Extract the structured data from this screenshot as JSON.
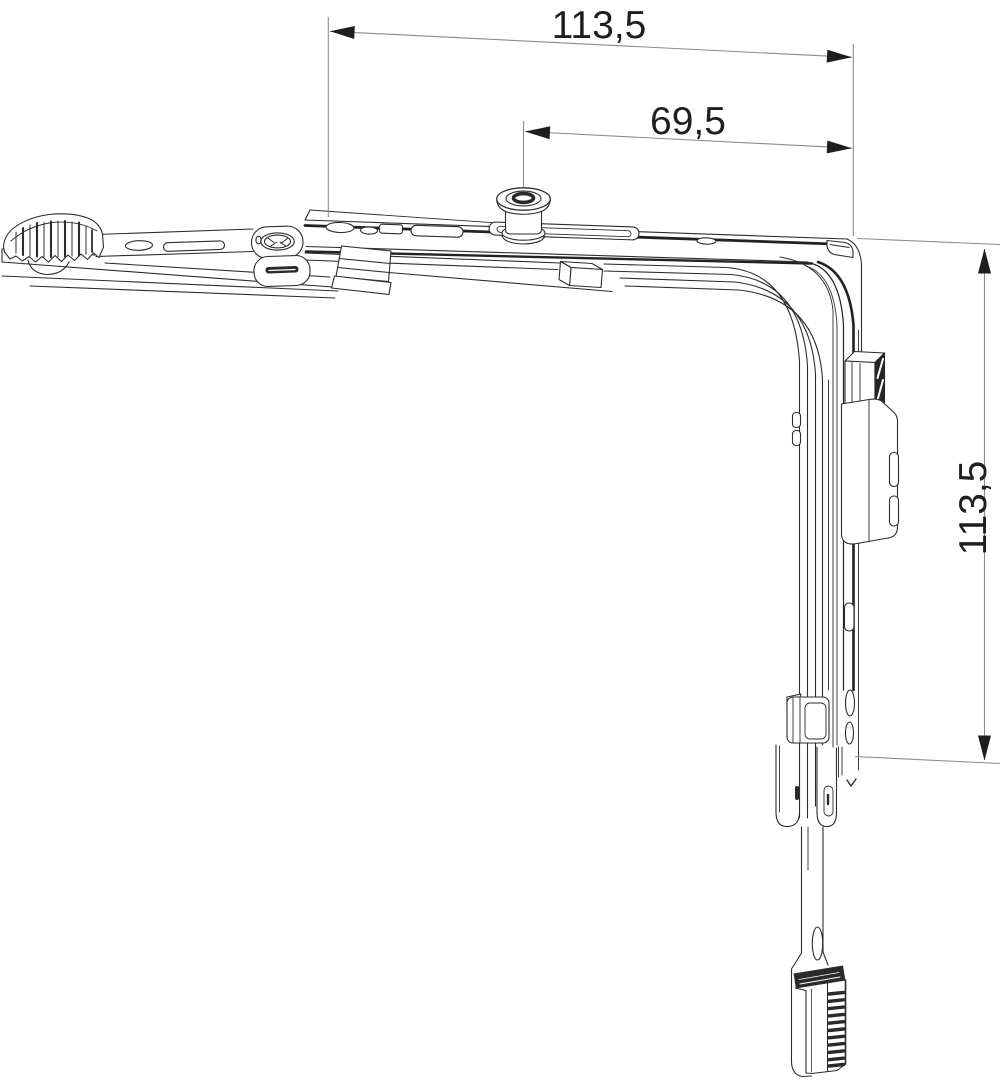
{
  "meta": {
    "kind": "technical-drawing",
    "subject": "window corner hinge / corner drive assembly",
    "unit_style": "decimal-comma millimetres",
    "background": "#ffffff"
  },
  "dimensions": {
    "top_width": {
      "label": "113,5",
      "orientation": "horizontal"
    },
    "pin_offset": {
      "label": "69,5",
      "orientation": "horizontal"
    },
    "side_height": {
      "label": "113,5",
      "orientation": "vertical"
    }
  },
  "colors": {
    "outline": "#2e2d2c",
    "dark_edge": "#232221",
    "dark_fill": "#2b2a29",
    "dimension_line": "#8c8c8c",
    "dimension_text": "#1f1e1d"
  }
}
